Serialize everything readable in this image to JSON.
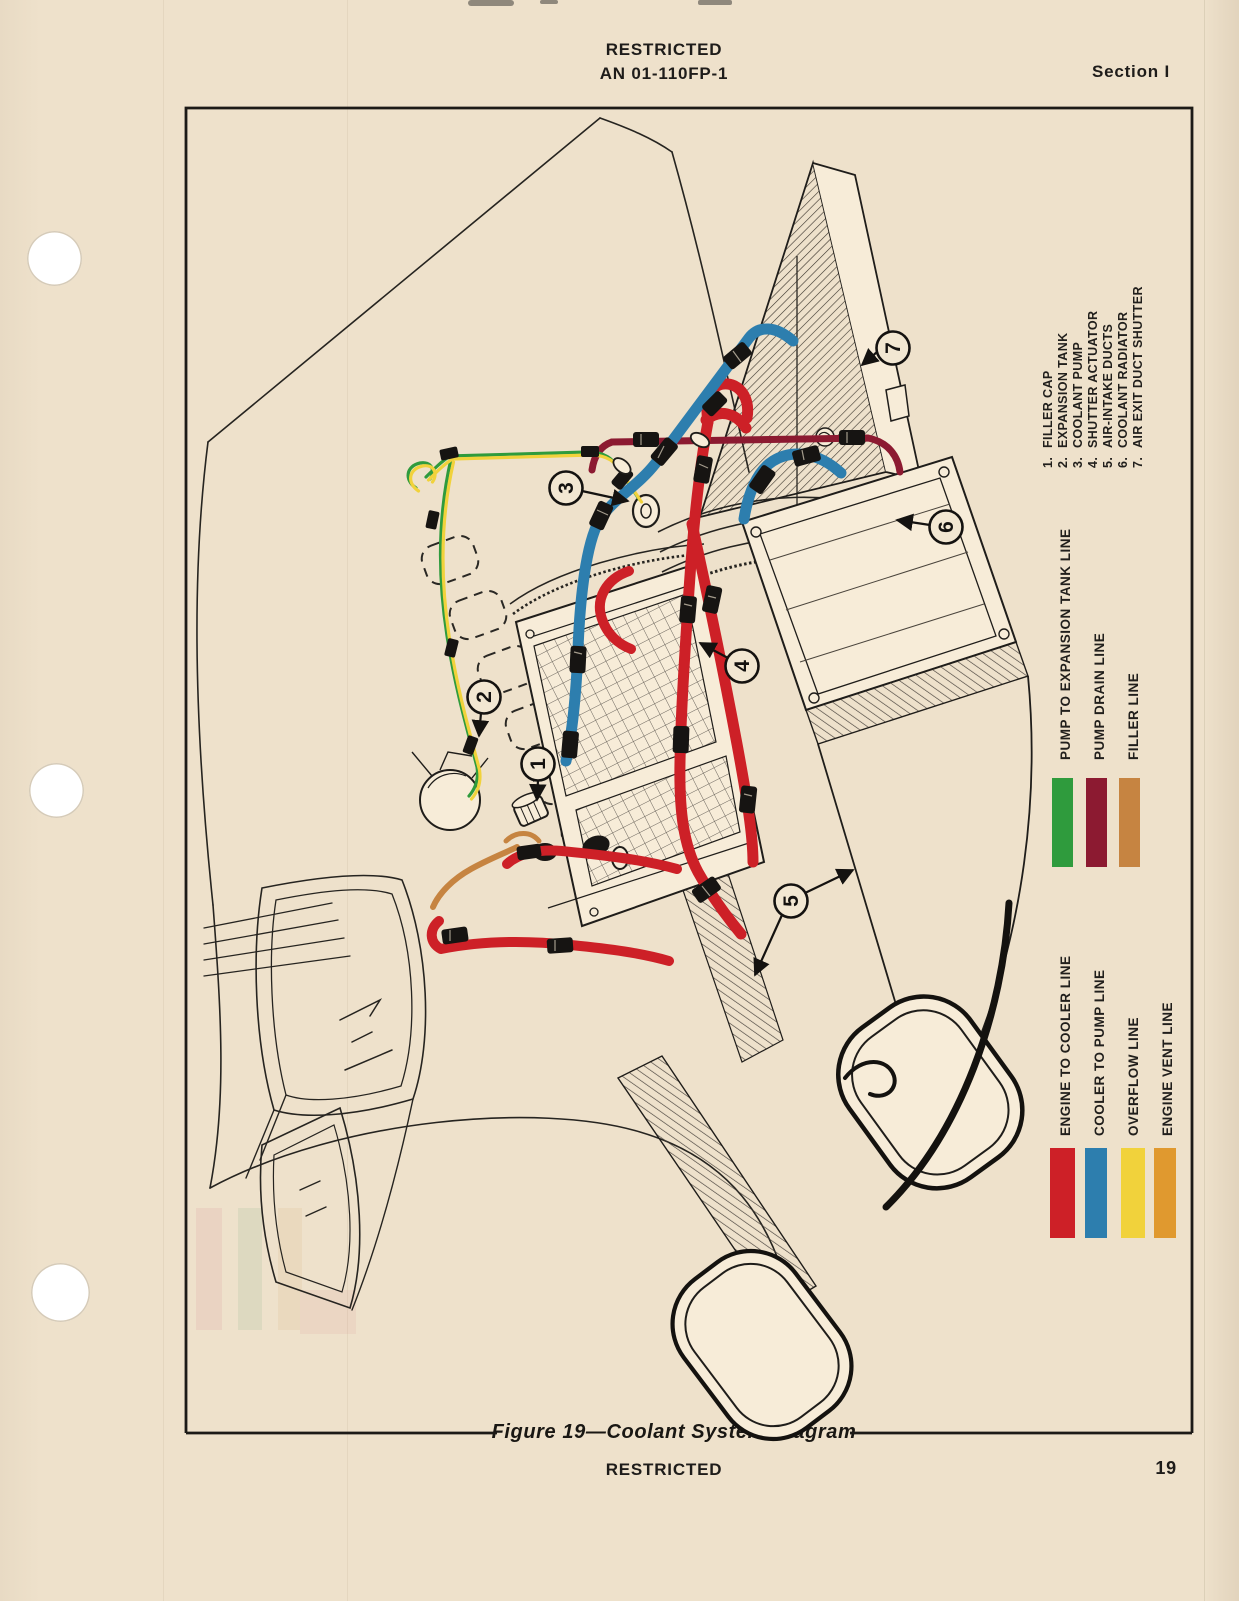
{
  "page": {
    "header": {
      "classification": "RESTRICTED",
      "doc_number": "AN 01-110FP-1",
      "section": "Section I"
    },
    "footer": {
      "classification": "RESTRICTED",
      "page_number": "19"
    },
    "figure": {
      "caption": "Figure 19—Coolant System Diagram",
      "parts_list": [
        {
          "num": "1.",
          "label": "FILLER CAP"
        },
        {
          "num": "2.",
          "label": "EXPANSION TANK"
        },
        {
          "num": "3.",
          "label": "COOLANT PUMP"
        },
        {
          "num": "4.",
          "label": "SHUTTER ACTUATOR"
        },
        {
          "num": "5.",
          "label": "AIR-INTAKE DUCTS"
        },
        {
          "num": "6.",
          "label": "COOLANT RADIATOR"
        },
        {
          "num": "7.",
          "label": "AIR EXIT DUCT SHUTTER"
        }
      ],
      "legend_upper": [
        {
          "label": "PUMP TO EXPANSION TANK LINE",
          "color": "#2f9b3d"
        },
        {
          "label": "PUMP DRAIN LINE",
          "color": "#8c1a31"
        },
        {
          "label": "FILLER LINE",
          "color": "#c68441"
        }
      ],
      "legend_lower": [
        {
          "label": "ENGINE TO COOLER LINE",
          "color": "#cd2027"
        },
        {
          "label": "COOLER TO PUMP LINE",
          "color": "#2d7eae"
        },
        {
          "label": "OVERFLOW LINE",
          "color": "#f1d23b"
        },
        {
          "label": "ENGINE VENT LINE",
          "color": "#e0992f"
        }
      ],
      "callouts": [
        {
          "n": "1"
        },
        {
          "n": "2"
        },
        {
          "n": "3"
        },
        {
          "n": "4"
        },
        {
          "n": "5"
        },
        {
          "n": "6"
        },
        {
          "n": "7"
        }
      ]
    },
    "colors": {
      "paper": "#eee1cb",
      "ink": "#1e1c1a",
      "hose_red": "#cd2027",
      "hose_blue": "#2d7eae",
      "line_green": "#2f9b3d",
      "line_yellow": "#f1d23b",
      "line_maroon": "#8c1a31",
      "line_brown": "#c68441"
    }
  }
}
